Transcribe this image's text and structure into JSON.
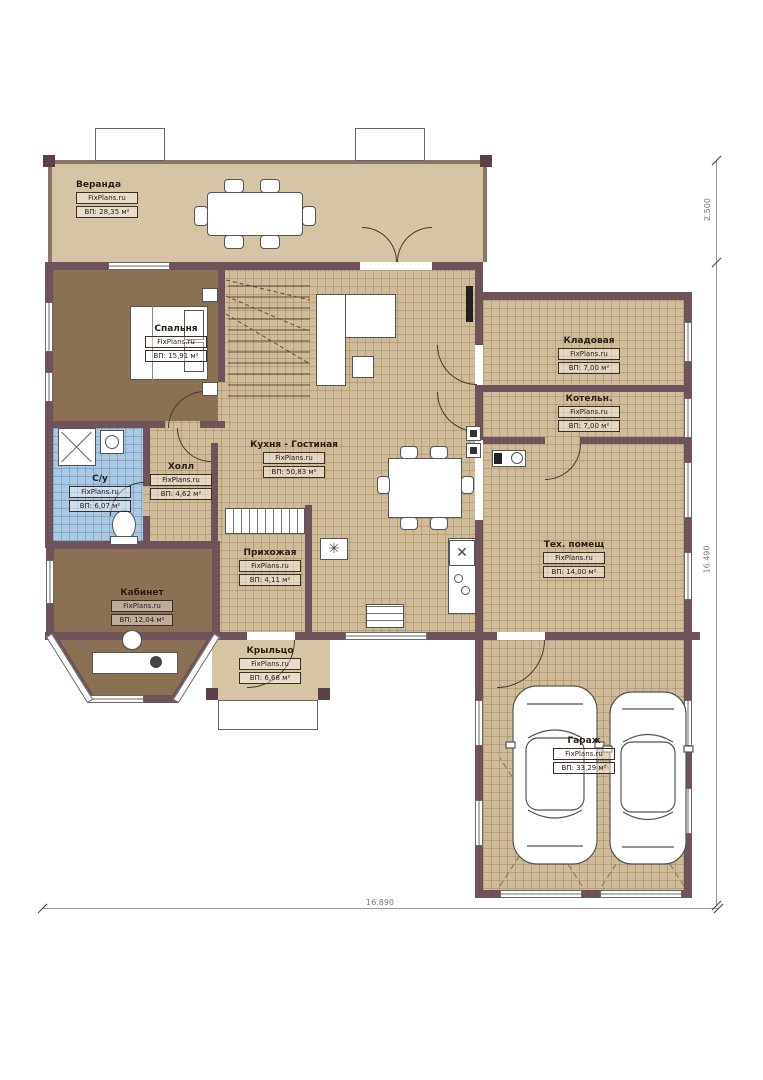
{
  "plan": {
    "watermark": "FixPlans.ru",
    "rooms": [
      {
        "id": "veranda",
        "name": "Веранда",
        "area": "ВП: 28,35 м²"
      },
      {
        "id": "bedroom",
        "name": "Спальня",
        "area": "ВП: 15,91 м²"
      },
      {
        "id": "kitchen-living",
        "name": "Кухня - Гостиная",
        "area": "ВП: 50,83 м²"
      },
      {
        "id": "hall",
        "name": "Холл",
        "area": "ВП: 4,62 м²"
      },
      {
        "id": "bathroom",
        "name": "С/у",
        "area": "ВП: 6,07 м²"
      },
      {
        "id": "study",
        "name": "Кабинет",
        "area": "ВП: 12,04 м²"
      },
      {
        "id": "entry-hall",
        "name": "Прихожая",
        "area": "ВП: 4,11 м²"
      },
      {
        "id": "porch",
        "name": "Крыльцо",
        "area": "ВП: 6,68 м²"
      },
      {
        "id": "storage",
        "name": "Кладовая",
        "area": "ВП: 7,00 м²"
      },
      {
        "id": "boiler",
        "name": "Котельн.",
        "area": "ВП: 7,00 м²"
      },
      {
        "id": "tech",
        "name": "Тех. помещ",
        "area": "ВП: 14,00 м²"
      },
      {
        "id": "garage",
        "name": "Гараж",
        "area": "ВП: 33,29 м²"
      }
    ],
    "dimensions": {
      "veranda_depth": "2.500",
      "house_depth": "16.490",
      "house_width": "16.890"
    },
    "icons": {
      "cooktop": "✳",
      "sink": "✕"
    },
    "colors": {
      "wall": "#6e545a",
      "tile": "#cebb97",
      "wood": "#8b7153",
      "bath_tile": "#a9c9e2",
      "veranda_floor": "#d5c5a5"
    }
  }
}
